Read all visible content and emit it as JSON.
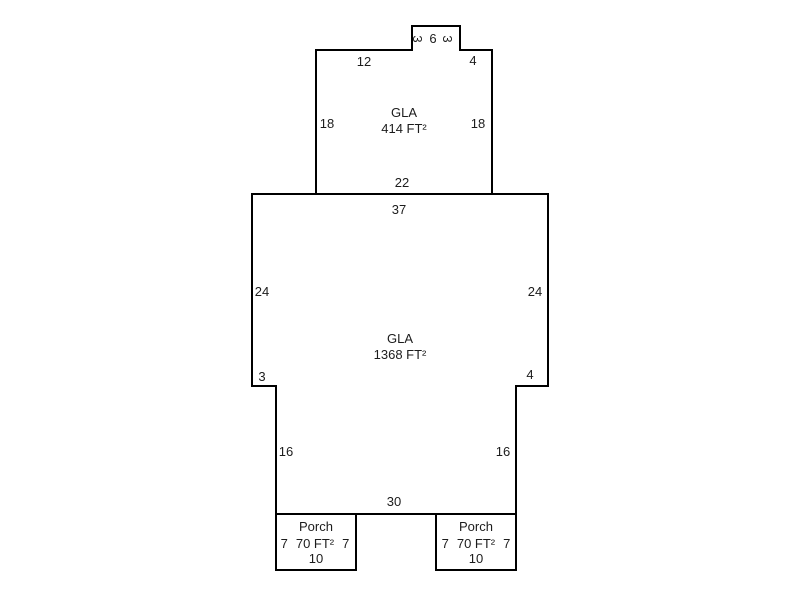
{
  "colors": {
    "line": "#000000",
    "text": "#1c1c1c",
    "background": "#ffffff"
  },
  "units": {
    "upper": {
      "name": "GLA",
      "area": "414 FT²",
      "dims": {
        "bump_side_left": "3",
        "bump_top": "6",
        "bump_side_right": "3",
        "top_left": "12",
        "top_right": "4",
        "side_left": "18",
        "side_right": "18",
        "bottom": "22"
      }
    },
    "main": {
      "name": "GLA",
      "area": "1368 FT²",
      "dims": {
        "top": "37",
        "side_left": "24",
        "side_right": "24",
        "step_left": "3",
        "step_right": "4",
        "lower_side_left": "16",
        "lower_side_right": "16",
        "bottom": "30"
      }
    },
    "porch_left": {
      "name": "Porch",
      "side_left": "7",
      "area": "70 FT²",
      "side_right": "7",
      "bottom": "10"
    },
    "porch_right": {
      "name": "Porch",
      "side_left": "7",
      "area": "70 FT²",
      "side_right": "7",
      "bottom": "10"
    }
  }
}
